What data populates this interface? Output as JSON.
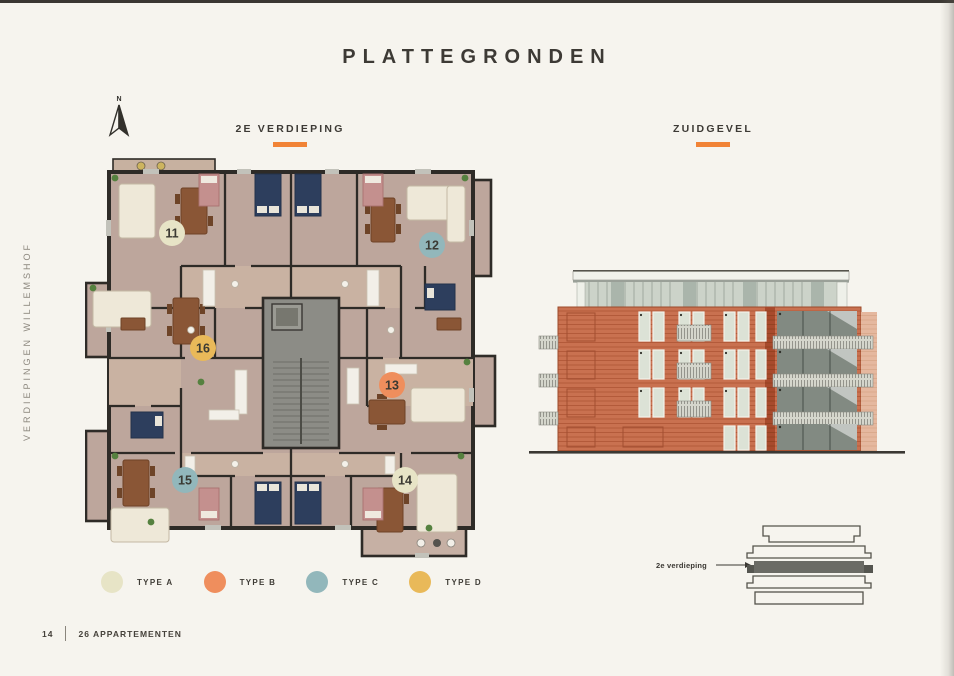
{
  "page": {
    "title": "PLATTEGRONDEN",
    "side_label": "VERDIEPINGEN WILLEMSHOF",
    "accent_color": "#f18336",
    "background_color": "#f6f4ee"
  },
  "floorplan": {
    "heading": "2E VERDIEPING",
    "compass_label": "N",
    "units": [
      {
        "number": "11",
        "type": "A",
        "color": "#e7e4c6"
      },
      {
        "number": "12",
        "type": "C",
        "color": "#92b7bb"
      },
      {
        "number": "13",
        "type": "B",
        "color": "#ef8e5d"
      },
      {
        "number": "14",
        "type": "A",
        "color": "#e7e4c6"
      },
      {
        "number": "15",
        "type": "C",
        "color": "#92b7bb"
      },
      {
        "number": "16",
        "type": "D",
        "color": "#e9b959"
      }
    ]
  },
  "elevation": {
    "heading": "ZUIDGEVEL"
  },
  "stack_diagram": {
    "label": "2e verdieping"
  },
  "legend": {
    "items": [
      {
        "label": "TYPE A",
        "color": "#e7e4c6"
      },
      {
        "label": "TYPE B",
        "color": "#ef8e5d"
      },
      {
        "label": "TYPE C",
        "color": "#92b7bb"
      },
      {
        "label": "TYPE D",
        "color": "#e9b959"
      }
    ]
  },
  "footer": {
    "page_number": "14",
    "project": "26 APPARTEMENTEN"
  }
}
